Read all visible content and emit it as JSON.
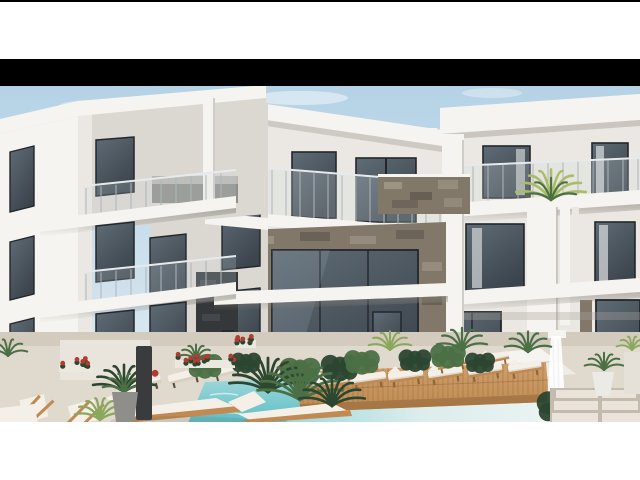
{
  "image_type": "3D architectural exterior rendering, letterboxed between a thin black top rule, a black bar and white margins",
  "scene": {
    "description": "Modern three-storey white apartment complex wrapping around a courtyard swimming pool with a wooden sun deck, rows of sun loungers with white cushions, tropical plants, a white cascade fountain and stone-clad facade accents under a clear pale blue sky",
    "time_of_day": "daytime, sunlit from the left",
    "objects": [
      "left-apartment-wing-in-perspective",
      "middle-apartment-block-with-stone-portal",
      "right-apartment-block",
      "glass-balcony-railings",
      "stone-clad-balcony-parapet",
      "dark-stone-pillar",
      "white-canopy-slab",
      "balcony-palm-plant",
      "swimming-pool",
      "wooden-pool-deck",
      "deck-sun-loungers",
      "terrace-loungers-with-red-bolsters",
      "foreground-sling-chairs",
      "foreground-chaise-lounges",
      "cascade-fountain",
      "red-flowering-planters",
      "palm-bushes",
      "potted-plants",
      "stone-pavers"
    ],
    "counts": {
      "building_wings": 3,
      "visible_floors": 3,
      "deck_loungers": 6,
      "terrace_loungers_red_bolster": 3,
      "foreground_chaises": 3,
      "foreground_sling_chairs": 2,
      "fountains": 1,
      "pools": 1
    }
  },
  "letterbox": {
    "top_rule_px": 2,
    "white_gap_top_px": 57,
    "black_bar_top_px": 59,
    "black_bar_height_px": 27,
    "photo_top_px": 86,
    "photo_bottom_px": 422,
    "white_bottom_px": 58
  },
  "palette": {
    "letterbox": "#000000",
    "page_bg": "#ffffff",
    "sky_top": "#b5d2e6",
    "sky_bottom": "#e3eef5",
    "cloud": "#f2f7fa",
    "wall_bright": "#f6f4f0",
    "wall_light": "#ebe8e3",
    "wall_mid": "#dbd7d1",
    "wall_dark": "#c3bfb8",
    "soffit_shadow": "#a9a49c",
    "glass_dark": "#3c444c",
    "glass_mid": "#5f6c76",
    "curtain": "#ccd0d2",
    "frame_dark": "#23272b",
    "stone_light": "#a39a8b",
    "stone_mid": "#81786a",
    "stone_dark": "#5c544a",
    "stone_black": "#35383b",
    "wood": "#c08a52",
    "wood_dark": "#8f6537",
    "deck_light": "#cf9f6b",
    "deck_gap": "#9a7448",
    "cushion": "#f4f0e8",
    "cushion_shadow": "#d8d1c2",
    "red_accent": "#b23c31",
    "water_deep": "#5ebec6",
    "water_light": "#9fd8da",
    "water_pale": "#dcedec",
    "green_dark": "#2c4630",
    "green_mid": "#4b7046",
    "green_light": "#8aa85c",
    "palm_light": "#aabd66",
    "terrace": "#e0d9cd",
    "terrace_shadow": "#c2bbae",
    "paver": "#e9e3da",
    "pot_gray": "#8f8e8a",
    "white_pure": "#ffffff"
  }
}
